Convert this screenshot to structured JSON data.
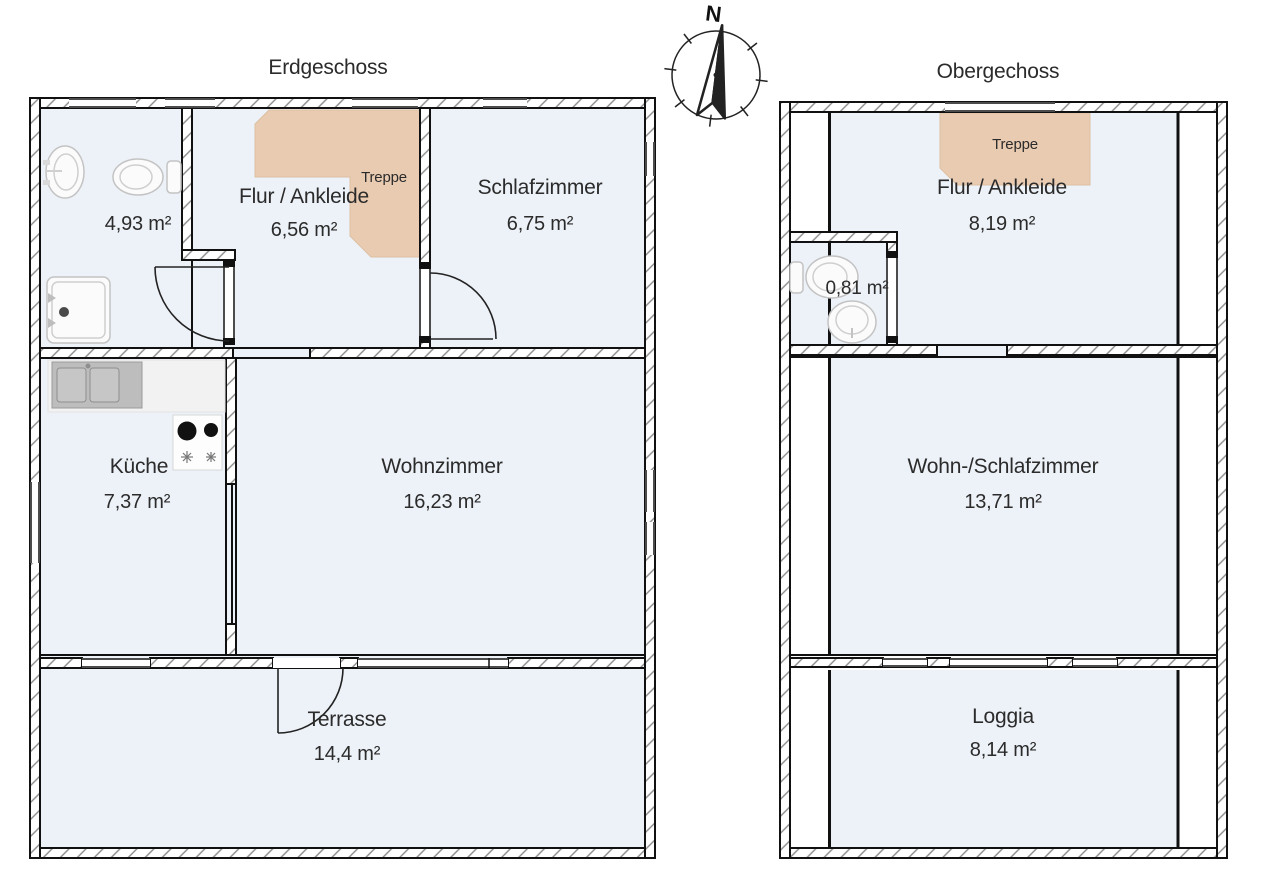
{
  "erdgeschoss": {
    "title": "Erdgeschoss",
    "bathroom_area": "4,93 m²",
    "flur_name": "Flur / Ankleide",
    "flur_area": "6,56 m²",
    "treppe_label": "Treppe",
    "schlafzimmer_name": "Schlafzimmer",
    "schlafzimmer_area": "6,75 m²",
    "kueche_name": "Küche",
    "kueche_area": "7,37 m²",
    "wohnzimmer_name": "Wohnzimmer",
    "wohnzimmer_area": "16,23 m²",
    "terrasse_name": "Terrasse",
    "terrasse_area": "14,4 m²"
  },
  "obergeschoss": {
    "title": "Obergechoss",
    "treppe_label": "Treppe",
    "flur_name": "Flur / Ankleide",
    "flur_area": "8,19 m²",
    "wc_area": "0,81 m²",
    "wohn_name": "Wohn-/Schlafzimmer",
    "wohn_area": "13,71 m²",
    "loggia_name": "Loggia",
    "loggia_area": "8,14 m²"
  },
  "compass": {
    "north_label": "N"
  },
  "colors": {
    "floor": "#edf2f8",
    "stairs": "#e9cbb1",
    "wall_outline": "#111111",
    "hatch": "#8a8a8a",
    "text": "#2b2b2b"
  }
}
